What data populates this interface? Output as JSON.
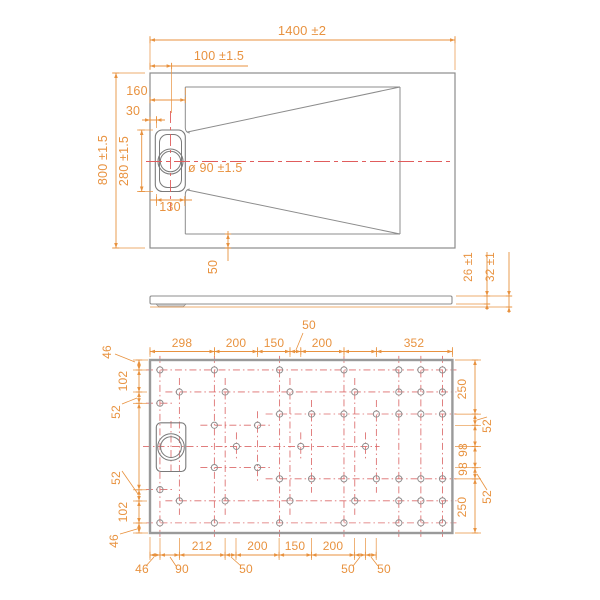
{
  "colors": {
    "dimension": "#E8923F",
    "outline": "#8C8C8C",
    "outline_dark": "#7A7A7A",
    "thick_border": "#9A9A9A",
    "construction_red": "#DC6B6B",
    "centerline_red": "#E05C5C",
    "bump_fill": "#C9C9C9",
    "background": "#FFFFFF"
  },
  "top_view": {
    "labels": [
      {
        "id": "overall-width",
        "text": "1400 ±2",
        "x": 302,
        "y": 35,
        "rot": 0,
        "size": 13,
        "anchor": "middle"
      },
      {
        "id": "drain-center-offset",
        "text": "100 ±1.5",
        "x": 219,
        "y": 60,
        "rot": 0,
        "size": 12.5,
        "anchor": "middle"
      },
      {
        "id": "floor-inset",
        "text": "160",
        "x": 137,
        "y": 95,
        "rot": 0,
        "size": 12.5,
        "anchor": "middle"
      },
      {
        "id": "channel-edge-offset",
        "text": "30",
        "x": 133,
        "y": 115,
        "rot": 0,
        "size": 12.5,
        "anchor": "middle"
      },
      {
        "id": "overall-depth",
        "text": "800 ±1.5",
        "x": 107,
        "y": 160,
        "rot": -90,
        "size": 12.5,
        "anchor": "middle"
      },
      {
        "id": "channel-length",
        "text": "280 ±1.5",
        "x": 128,
        "y": 161,
        "rot": -90,
        "size": 12.5,
        "anchor": "middle"
      },
      {
        "id": "drain-diameter",
        "text": "ø 90 ±1.5",
        "x": 188,
        "y": 172,
        "rot": 0,
        "size": 12.5,
        "anchor": "start"
      },
      {
        "id": "channel-width",
        "text": "130",
        "x": 170,
        "y": 211,
        "rot": 0,
        "size": 12.5,
        "anchor": "middle"
      },
      {
        "id": "border-width",
        "text": "50",
        "x": 217,
        "y": 267,
        "rot": -90,
        "size": 12.5,
        "anchor": "middle"
      }
    ]
  },
  "side_view": {
    "labels": [
      {
        "id": "edge-thickness",
        "text": "26 ±1",
        "x": 472,
        "y": 267,
        "rot": -90,
        "size": 11.5,
        "anchor": "middle"
      },
      {
        "id": "total-thickness",
        "text": "32 ±1",
        "x": 494,
        "y": 267,
        "rot": -90,
        "size": 11.5,
        "anchor": "middle"
      }
    ]
  },
  "bottom_view": {
    "top_chain": {
      "labels": [
        {
          "text": "298",
          "x": 182,
          "y": 347
        },
        {
          "text": "200",
          "x": 236,
          "y": 347
        },
        {
          "text": "150",
          "x": 274,
          "y": 347
        },
        {
          "text": "200",
          "x": 322,
          "y": 347
        },
        {
          "text": "352",
          "x": 414,
          "y": 347
        }
      ],
      "leader_label": {
        "text": "50",
        "x": 309,
        "y": 329
      }
    },
    "left_chain": {
      "labels": [
        {
          "text": "46",
          "x": 111,
          "y": 352
        },
        {
          "text": "102",
          "x": 127,
          "y": 381
        },
        {
          "text": "52",
          "x": 120,
          "y": 412
        },
        {
          "text": "52",
          "x": 120,
          "y": 478
        },
        {
          "text": "102",
          "x": 127,
          "y": 512
        },
        {
          "text": "46",
          "x": 118,
          "y": 541
        }
      ]
    },
    "right_chain": {
      "labels": [
        {
          "text": "250",
          "x": 466,
          "y": 389
        },
        {
          "text": "52",
          "x": 491,
          "y": 426
        },
        {
          "text": "98",
          "x": 467,
          "y": 450
        },
        {
          "text": "98",
          "x": 467,
          "y": 469
        },
        {
          "text": "52",
          "x": 491,
          "y": 497
        },
        {
          "text": "250",
          "x": 466,
          "y": 507
        }
      ]
    },
    "bottom_chain": {
      "labels": [
        {
          "text": "212",
          "x": 202,
          "y": 550
        },
        {
          "text": "200",
          "x": 257.5,
          "y": 550
        },
        {
          "text": "150",
          "x": 295,
          "y": 550
        },
        {
          "text": "200",
          "x": 333,
          "y": 550
        }
      ],
      "leader_labels": [
        {
          "text": "46",
          "x": 142,
          "y": 573
        },
        {
          "text": "90",
          "x": 182,
          "y": 573
        },
        {
          "text": "50",
          "x": 246,
          "y": 573
        },
        {
          "text": "50",
          "x": 348,
          "y": 573
        },
        {
          "text": "50",
          "x": 384,
          "y": 573
        }
      ]
    },
    "holes_mm": [
      {
        "y": 46,
        "x": [
          46,
          298,
          600,
          898,
          1152,
          1254,
          1354
        ]
      },
      {
        "y": 148,
        "x": [
          136,
          348,
          648,
          948,
          1152,
          1254,
          1354
        ]
      },
      {
        "y": 200,
        "x": [
          46
        ]
      },
      {
        "y": 250,
        "x": [
          600,
          748,
          898,
          1048,
          1152,
          1254,
          1354
        ]
      },
      {
        "y": 302,
        "x": [
          298,
          498
        ]
      },
      {
        "y": 400,
        "x": [
          400,
          698,
          998
        ]
      },
      {
        "y": 498,
        "x": [
          298,
          498
        ]
      },
      {
        "y": 550,
        "x": [
          600,
          748,
          898,
          1048,
          1152,
          1254,
          1354
        ]
      },
      {
        "y": 600,
        "x": [
          46
        ]
      },
      {
        "y": 652,
        "x": [
          136,
          348,
          648,
          948,
          1152,
          1254,
          1354
        ]
      },
      {
        "y": 754,
        "x": [
          46,
          298,
          600,
          898,
          1152,
          1254,
          1354
        ]
      }
    ]
  },
  "geometry": {
    "scale_px_per_mm": 0.216,
    "top_rect": {
      "x": 150,
      "y": 73,
      "w": 305,
      "h": 175
    },
    "inner_lines": [
      [
        185.3,
        87,
        400,
        87
      ],
      [
        400,
        87,
        400,
        234
      ],
      [
        185.3,
        234,
        400,
        234
      ],
      [
        185.3,
        87,
        185.3,
        128
      ],
      [
        185.3,
        194,
        185.3,
        234
      ],
      [
        400,
        87,
        187.5,
        132
      ],
      [
        400,
        234,
        187.5,
        190
      ]
    ],
    "channel_outer": {
      "x": 155.3,
      "y": 130,
      "w": 30,
      "h": 61.5,
      "r": 7
    },
    "channel_inner": {
      "x": 159.5,
      "y": 134.5,
      "w": 22,
      "h": 53,
      "r": 8
    },
    "drain_circle": {
      "cx": 170.5,
      "cy": 161.5,
      "r1": 12.5,
      "r2": 10.2
    },
    "profile_rect": {
      "x": 150,
      "y": 296,
      "w": 302,
      "h": 8
    },
    "profile_bump": "156,304 186,304 183,307 159,307",
    "bottom_rect": {
      "x": 150,
      "y": 360,
      "w": 302.4,
      "h": 173
    },
    "bottom_drain": {
      "x": 156.3,
      "y": 422.8,
      "w": 29.5,
      "h": 48.7,
      "r": 4.5,
      "cx": 171,
      "cy": 447.1,
      "r1": 13.3,
      "r2": 10.4
    },
    "chains": {
      "top": {
        "type": "h",
        "pos": 351.5,
        "ticks": [
          150,
          214.5,
          257.6,
          290,
          300.8,
          344,
          376.4,
          452.4
        ]
      },
      "left": {
        "type": "v",
        "pos": 139,
        "ticks": [
          360,
          370,
          392,
          403.3,
          489.8,
          501,
          523,
          533
        ]
      },
      "right": {
        "type": "v",
        "pos": 475,
        "ticks": [
          360,
          414.1,
          425.3,
          446.5,
          467.7,
          478.9,
          533
        ]
      },
      "bottom": {
        "type": "h",
        "pos": 555,
        "ticks": [
          150,
          160,
          179.4,
          225.1,
          236,
          279.1,
          311.5,
          354.6,
          365.4,
          376.2
        ]
      }
    },
    "dims": [
      {
        "type": "h",
        "pos": 40,
        "ticks": [
          150,
          455
        ],
        "style": "inner",
        "x1": 150,
        "x2": 455
      },
      {
        "type": "h",
        "pos": 66,
        "ticks": [
          150,
          171.6
        ],
        "style": "inner",
        "x1": 150,
        "x2": 248
      },
      {
        "type": "h",
        "pos": 100,
        "ticks": [
          150,
          185.3
        ],
        "style": "inner",
        "x1": 150,
        "x2": 185.3
      },
      {
        "type": "h",
        "pos": 120,
        "ticks": [
          150,
          156.5
        ],
        "style": "outside",
        "x1": 142,
        "x2": 165
      },
      {
        "type": "v",
        "pos": 116,
        "ticks": [
          73,
          248
        ],
        "style": "inner",
        "x1": 73,
        "x2": 248
      },
      {
        "type": "v",
        "pos": 141.7,
        "ticks": [
          130,
          191.5
        ],
        "style": "inner",
        "x1": 130,
        "x2": 191.5
      },
      {
        "type": "h",
        "pos": 200,
        "ticks": [
          156.5,
          184.8
        ],
        "style": "inner",
        "x1": 150,
        "x2": 192
      },
      {
        "type": "v",
        "pos": 228,
        "ticks": [
          234,
          248
        ],
        "style": "inner",
        "x1": 231,
        "x2": 261
      },
      {
        "type": "v",
        "pos": 487,
        "ticks": [
          296,
          304
        ],
        "style": "outside",
        "x1": 252,
        "x2": 310
      },
      {
        "type": "v",
        "pos": 509,
        "ticks": [
          296,
          307
        ],
        "style": "outside",
        "x1": 252,
        "x2": 313
      }
    ],
    "ext_lines": [
      [
        150,
        70,
        150,
        36
      ],
      [
        455,
        70,
        455,
        36
      ],
      [
        171.6,
        63,
        171.6,
        113
      ],
      [
        185.3,
        95,
        185.3,
        88
      ],
      [
        156.5,
        116,
        156.5,
        128
      ],
      [
        145,
        73,
        112,
        73
      ],
      [
        145,
        248,
        112,
        248
      ],
      [
        153,
        130,
        137,
        130
      ],
      [
        153,
        191.5,
        137,
        191.5
      ],
      [
        156.5,
        194,
        156.5,
        206
      ],
      [
        184.8,
        196,
        184.8,
        206
      ],
      [
        456,
        296,
        512,
        296
      ],
      [
        456,
        304,
        490,
        304
      ],
      [
        150,
        307,
        512,
        307
      ],
      [
        214.5,
        357,
        214.5,
        347
      ],
      [
        257.6,
        357,
        257.6,
        347
      ],
      [
        290,
        357,
        290,
        347
      ],
      [
        300.8,
        357,
        300.8,
        347
      ],
      [
        344,
        357,
        344,
        347
      ],
      [
        376.4,
        357,
        376.4,
        347
      ],
      [
        150,
        357,
        150,
        347
      ],
      [
        452.4,
        357,
        452.4,
        347
      ],
      [
        147,
        370,
        133,
        370
      ],
      [
        147,
        392,
        133,
        392
      ],
      [
        147,
        403.3,
        133,
        403.3
      ],
      [
        147,
        489.8,
        133,
        489.8
      ],
      [
        147,
        501,
        133,
        501
      ],
      [
        147,
        523,
        133,
        523
      ],
      [
        148,
        360,
        133,
        360
      ],
      [
        148,
        533,
        133,
        533
      ],
      [
        455,
        414.1,
        481,
        414.1
      ],
      [
        455,
        425.3,
        481,
        425.3
      ],
      [
        455,
        446.5,
        481,
        446.5
      ],
      [
        455,
        467.7,
        481,
        467.7
      ],
      [
        455,
        478.9,
        481,
        478.9
      ],
      [
        455,
        360,
        481,
        360
      ],
      [
        455,
        533,
        481,
        533
      ],
      [
        160,
        538,
        160,
        560
      ],
      [
        179.4,
        538,
        179.4,
        560
      ],
      [
        225.1,
        538,
        225.1,
        560
      ],
      [
        236,
        538,
        236,
        560
      ],
      [
        279.1,
        538,
        279.1,
        560
      ],
      [
        311.5,
        538,
        311.5,
        560
      ],
      [
        354.6,
        538,
        354.6,
        560
      ],
      [
        365.4,
        538,
        365.4,
        560
      ],
      [
        376.2,
        538,
        376.2,
        560
      ],
      [
        150,
        537,
        150,
        560
      ]
    ],
    "leaders": [
      [
        303,
        333,
        296,
        350
      ],
      [
        115,
        354,
        135,
        362
      ],
      [
        122,
        404,
        137,
        398
      ],
      [
        122,
        471,
        138,
        494
      ],
      [
        120,
        534,
        137,
        529
      ],
      [
        487,
        417,
        477,
        420
      ],
      [
        487,
        490,
        477,
        474
      ],
      [
        146,
        566,
        154,
        557
      ],
      [
        176,
        566,
        170,
        557
      ],
      [
        241,
        566,
        231,
        557
      ],
      [
        353,
        566,
        360,
        557
      ],
      [
        378,
        566,
        371,
        557
      ]
    ],
    "centerlines": {
      "h": [
        146,
        161.5,
        450,
        161.5
      ],
      "v": [
        170.5,
        111,
        170.5,
        210
      ]
    }
  }
}
